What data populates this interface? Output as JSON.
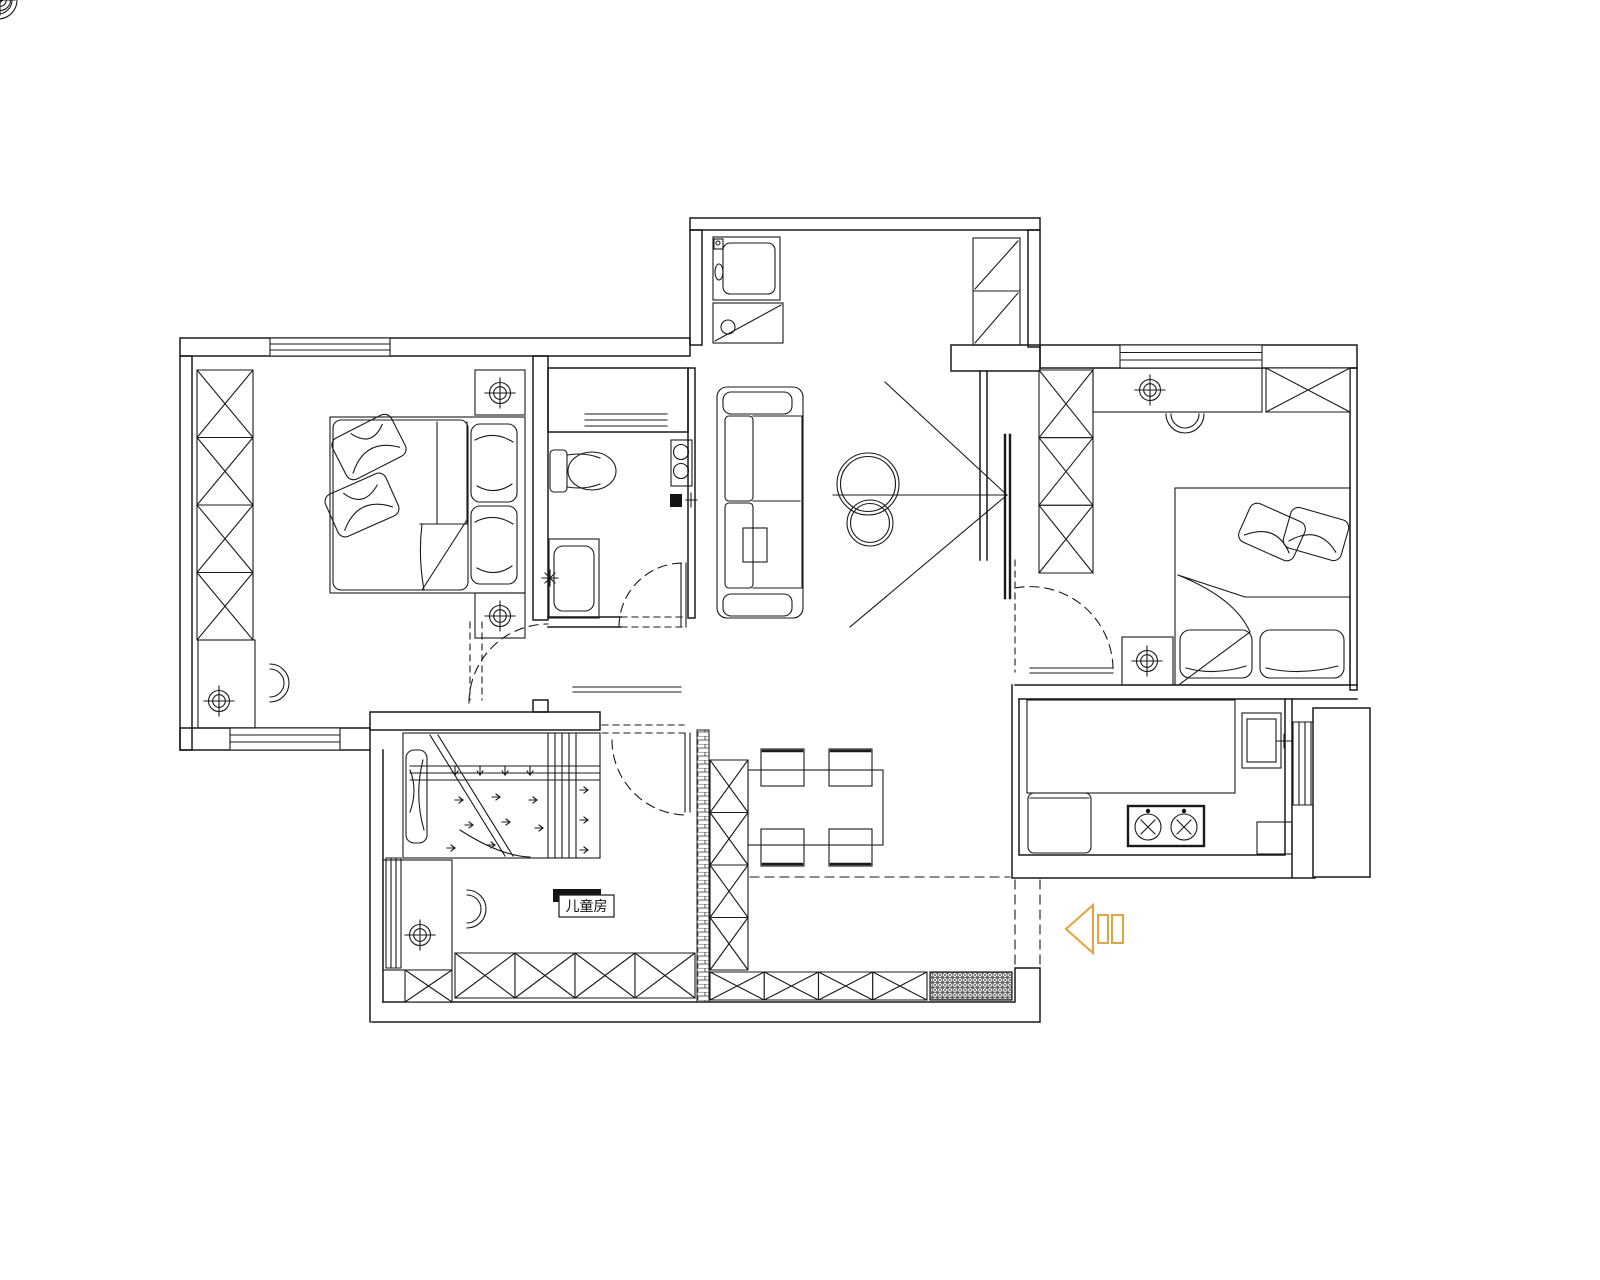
{
  "page": {
    "background": "#ffffff",
    "ink": "#1a1a1a",
    "width": 1600,
    "height": 1280,
    "type": "apartment-floor-plan"
  },
  "labels": {
    "children_room": "儿童房"
  },
  "icons": {
    "entry_arrow": {
      "name": "entry-direction-arrow-icon",
      "color": "#E8A23B",
      "direction": "left"
    }
  }
}
